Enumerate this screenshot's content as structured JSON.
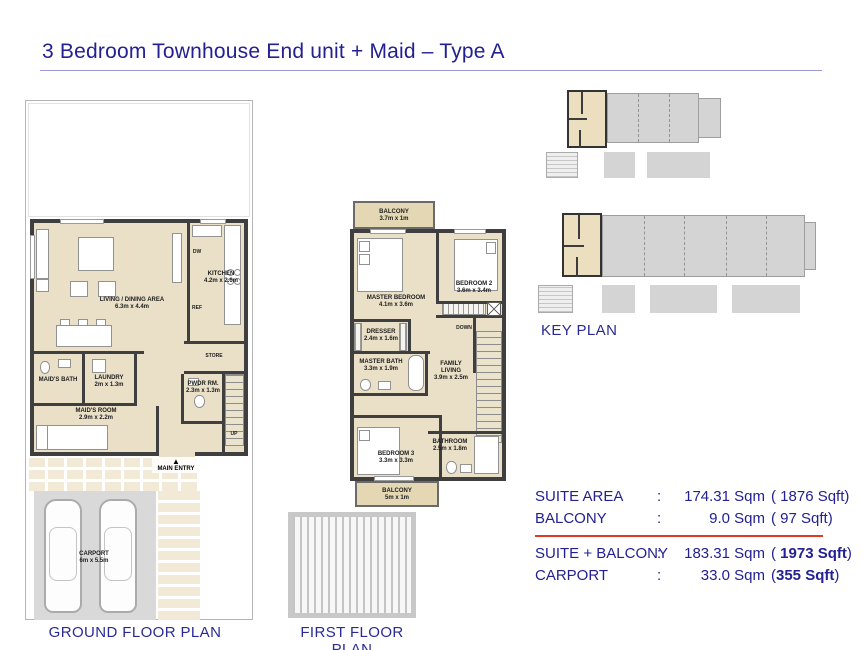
{
  "title": "3 Bedroom Townhouse End unit + Maid – Type A",
  "ground_floor": {
    "label": "GROUND FLOOR PLAN",
    "rooms": {
      "living": {
        "name": "LIVING / DINING AREA",
        "dims": "6.3m x 4.4m"
      },
      "kitchen": {
        "name": "KITCHEN",
        "dims": "4.2m x 2.6m"
      },
      "store": {
        "name": "STORE"
      },
      "pwdr": {
        "name": "PWDR RM.",
        "dims": "2.3m x 1.3m"
      },
      "laundry": {
        "name": "LAUNDRY",
        "dims": "2m x 1.3m"
      },
      "maids_bath": {
        "name": "MAID'S BATH"
      },
      "maids_room": {
        "name": "MAID'S ROOM",
        "dims": "2.9m x 2.2m"
      },
      "carport": {
        "name": "CARPORT",
        "dims": "6m x 5.5m"
      }
    },
    "annotations": {
      "dw": "DW",
      "ref": "REF",
      "up": "UP",
      "main_entry": "MAIN ENTRY",
      "entry_arrow": "▲"
    }
  },
  "first_floor": {
    "label": "FIRST FLOOR PLAN",
    "rooms": {
      "balcony_top": {
        "name": "BALCONY",
        "dims": "3.7m x 1m"
      },
      "master_bedroom": {
        "name": "MASTER BEDROOM",
        "dims": "4.1m x 3.6m"
      },
      "bedroom2": {
        "name": "BEDROOM 2",
        "dims": "3.6m x 3.4m"
      },
      "dresser": {
        "name": "DRESSER",
        "dims": "2.4m x 1.6m"
      },
      "master_bath": {
        "name": "MASTER BATH",
        "dims": "3.3m x 1.9m"
      },
      "family_living": {
        "name": "FAMILY LIVING",
        "dims": "3.9m x 2.5m"
      },
      "bedroom3": {
        "name": "BEDROOM 3",
        "dims": "3.3m x 3.3m"
      },
      "bathroom": {
        "name": "BATHROOM",
        "dims": "2.5m x 1.8m"
      },
      "balcony_bottom": {
        "name": "BALCONY",
        "dims": "5m x 1m"
      }
    },
    "annotations": {
      "down": "DOWN"
    }
  },
  "key_plan": {
    "label": "KEY PLAN"
  },
  "areas": {
    "rows": [
      {
        "label": "SUITE AREA",
        "colon": ":",
        "sqm": "174.31 Sqm",
        "sqft_pre": "( 1876 Sqft)",
        "sqft_strong": "",
        "sqft_post": ""
      },
      {
        "label": "BALCONY",
        "colon": ":",
        "sqm": "9.0 Sqm",
        "sqft_pre": "( 97 Sqft)",
        "sqft_strong": "",
        "sqft_post": ""
      },
      {
        "label": "SUITE + BALCONY",
        "colon": ":",
        "sqm": "183.31 Sqm",
        "sqft_pre": "( ",
        "sqft_strong": "1973 Sqft",
        "sqft_post": ")"
      },
      {
        "label": "CARPORT",
        "colon": ":",
        "sqm": "33.0 Sqm",
        "sqft_pre": "(",
        "sqft_strong": "355 Sqft",
        "sqft_post": ")"
      }
    ]
  },
  "colors": {
    "navy": "#232192",
    "red_line": "#e23b25",
    "floor_beige": "#eae0c8",
    "wall": "#3f3f3f",
    "key_gray": "#d4d4d4",
    "highlight_unit": "#ebdfbf"
  }
}
